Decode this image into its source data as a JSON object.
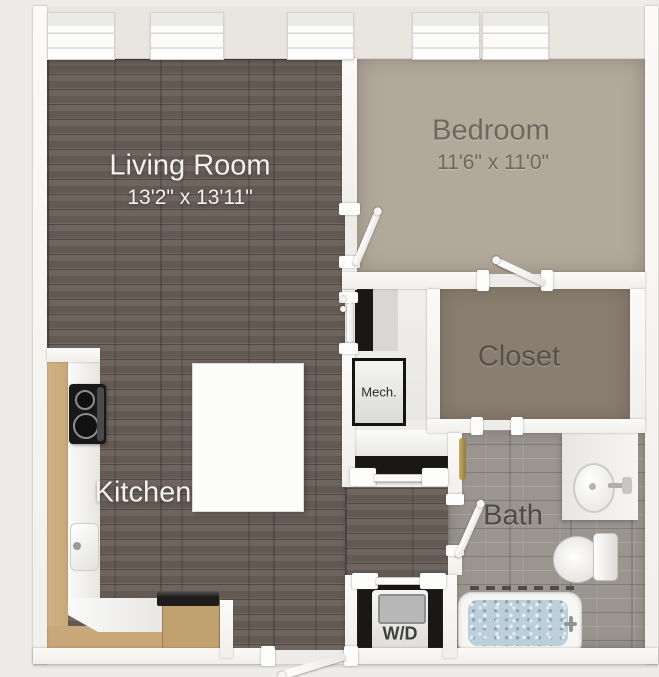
{
  "plan": {
    "living_room": {
      "label": "Living Room",
      "dimensions": "13'2\" x 13'11\""
    },
    "bedroom": {
      "label": "Bedroom",
      "dimensions": "11'6\" x 11'0\""
    },
    "closet": {
      "label": "Closet"
    },
    "kitchen": {
      "label": "Kitchen"
    },
    "bath": {
      "label": "Bath"
    },
    "mechanical": {
      "label": "Mech."
    },
    "washer_dryer": {
      "label": "W/D"
    }
  },
  "colors": {
    "background": "#edece8",
    "wall": "#f8f7f4",
    "wood": "#695f58",
    "bedroom_carpet": "#b2a99b",
    "closet_carpet": "#8a7e70",
    "bath_tile": "#9a958f",
    "cabinet": "#c8a778",
    "butcher": "#c2a170",
    "counter": "#f1f0ee",
    "island": "#fcfcfb",
    "fixture_black": "#1a1816",
    "tub_water": "#bccfdb",
    "towel_gold": "#b59a4f",
    "label_light": "#f3f1ed",
    "label_dark": "#5d574f"
  }
}
